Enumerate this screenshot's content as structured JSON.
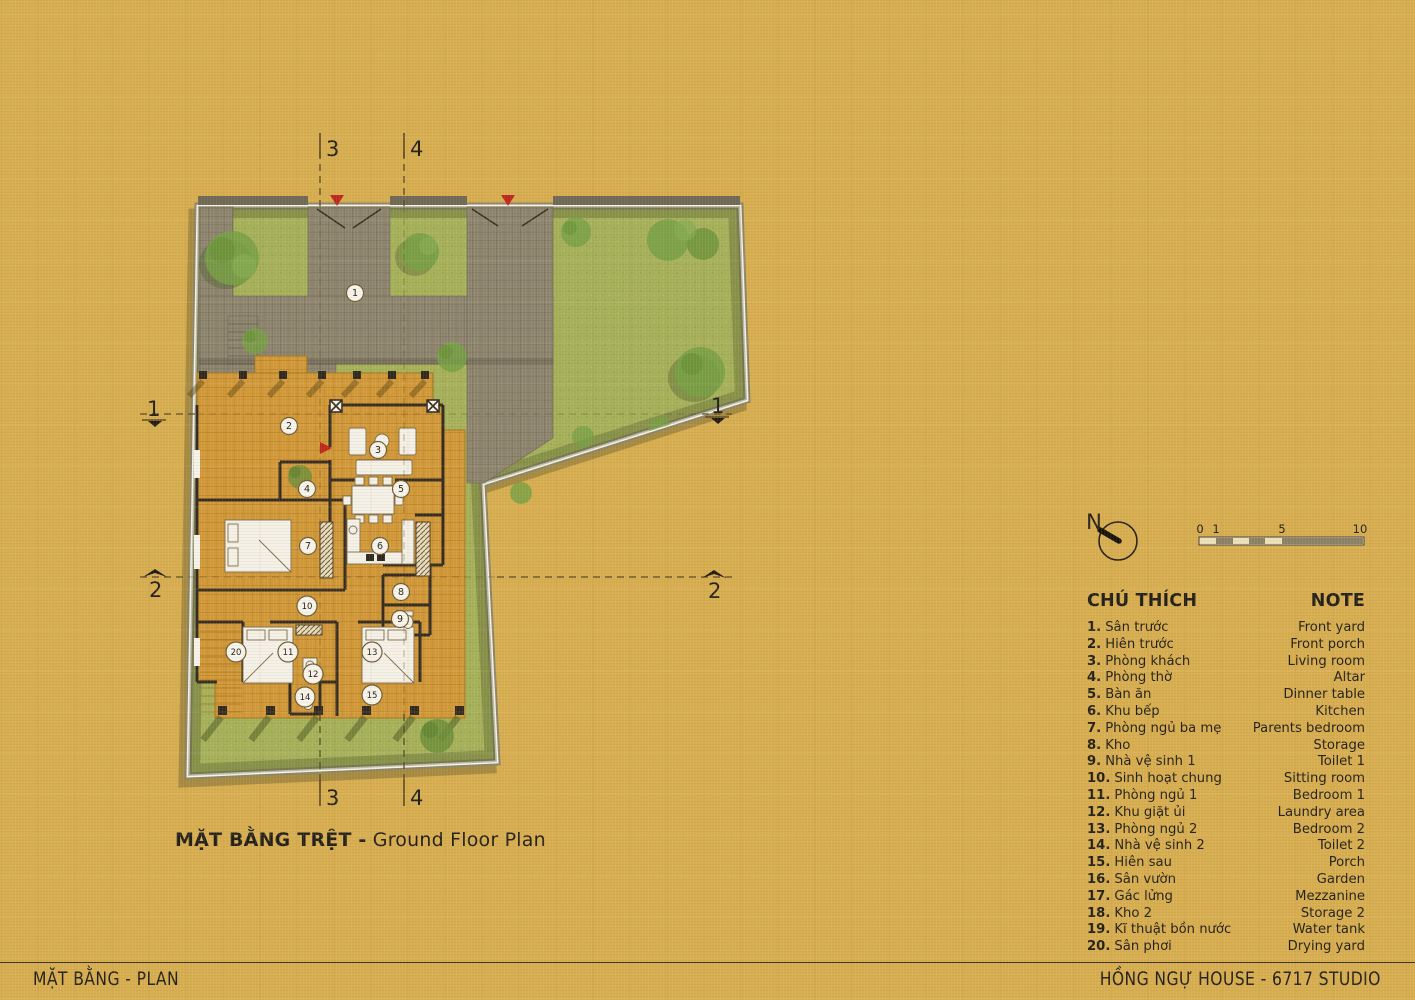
{
  "plan": {
    "title_bold": "MẶT BẰNG TRỆT -",
    "title_regular": "Ground Floor Plan",
    "rooms": [
      {
        "label": "1",
        "x": 355,
        "y": 293
      },
      {
        "label": "2",
        "x": 289,
        "y": 426
      },
      {
        "label": "3",
        "x": 378,
        "y": 450
      },
      {
        "label": "4",
        "x": 307,
        "y": 489
      },
      {
        "label": "5",
        "x": 401,
        "y": 489
      },
      {
        "label": "6",
        "x": 380,
        "y": 546
      },
      {
        "label": "7",
        "x": 308,
        "y": 546
      },
      {
        "label": "8",
        "x": 401,
        "y": 592
      },
      {
        "label": "9",
        "x": 400,
        "y": 619
      },
      {
        "label": "10",
        "x": 307,
        "y": 606
      },
      {
        "label": "11",
        "x": 288,
        "y": 652
      },
      {
        "label": "12",
        "x": 313,
        "y": 674
      },
      {
        "label": "13",
        "x": 372,
        "y": 652
      },
      {
        "label": "14",
        "x": 305,
        "y": 697
      },
      {
        "label": "15",
        "x": 372,
        "y": 695
      },
      {
        "label": "20",
        "x": 236,
        "y": 652
      }
    ],
    "sections": {
      "top_left": "3",
      "top_right": "4",
      "bottom_left": "3",
      "bottom_right": "4",
      "west_upper": "1",
      "east_upper": "1",
      "west_lower": "2",
      "east_lower": "2"
    }
  },
  "compass": {
    "label": "N"
  },
  "scalebar": {
    "ticks": [
      {
        "label": "0",
        "x": 1200
      },
      {
        "label": "1",
        "x": 1216
      },
      {
        "label": "5",
        "x": 1282
      },
      {
        "label": "10",
        "x": 1360
      }
    ]
  },
  "legend": {
    "title_vn": "CHÚ THÍCH",
    "title_en": "NOTE",
    "items": [
      {
        "no": "1.",
        "vn": "Sân trước",
        "en": "Front yard"
      },
      {
        "no": "2.",
        "vn": "Hiên trước",
        "en": "Front porch"
      },
      {
        "no": "3.",
        "vn": "Phòng khách",
        "en": "Living room"
      },
      {
        "no": "4.",
        "vn": "Phòng thờ",
        "en": "Altar"
      },
      {
        "no": "5.",
        "vn": "Bàn ăn",
        "en": "Dinner table"
      },
      {
        "no": "6.",
        "vn": "Khu bếp",
        "en": "Kitchen"
      },
      {
        "no": "7.",
        "vn": "Phòng ngủ ba mẹ",
        "en": "Parents bedroom"
      },
      {
        "no": "8.",
        "vn": "Kho",
        "en": "Storage"
      },
      {
        "no": "9.",
        "vn": "Nhà vệ sinh 1",
        "en": "Toilet 1"
      },
      {
        "no": "10.",
        "vn": "Sinh hoạt chung",
        "en": "Sitting room"
      },
      {
        "no": "11.",
        "vn": "Phòng ngủ 1",
        "en": "Bedroom 1"
      },
      {
        "no": "12.",
        "vn": "Khu giặt ủi",
        "en": "Laundry area"
      },
      {
        "no": "13.",
        "vn": "Phòng ngủ 2",
        "en": "Bedroom 2"
      },
      {
        "no": "14.",
        "vn": "Nhà vệ sinh 2",
        "en": "Toilet 2"
      },
      {
        "no": "15.",
        "vn": "Hiên sau",
        "en": "Porch"
      },
      {
        "no": "16.",
        "vn": "Sân vườn",
        "en": "Garden"
      },
      {
        "no": "17.",
        "vn": "Gác lửng",
        "en": "Mezzanine"
      },
      {
        "no": "18.",
        "vn": "Kho 2",
        "en": "Storage 2"
      },
      {
        "no": "19.",
        "vn": "Kĩ thuật bồn nước",
        "en": "Water tank"
      },
      {
        "no": "20.",
        "vn": "Sân phơi",
        "en": "Drying yard"
      }
    ]
  },
  "footer": {
    "left": "MẶT BẰNG - PLAN",
    "right": "HỒNG NGỰ HOUSE - 6717 STUDIO"
  }
}
